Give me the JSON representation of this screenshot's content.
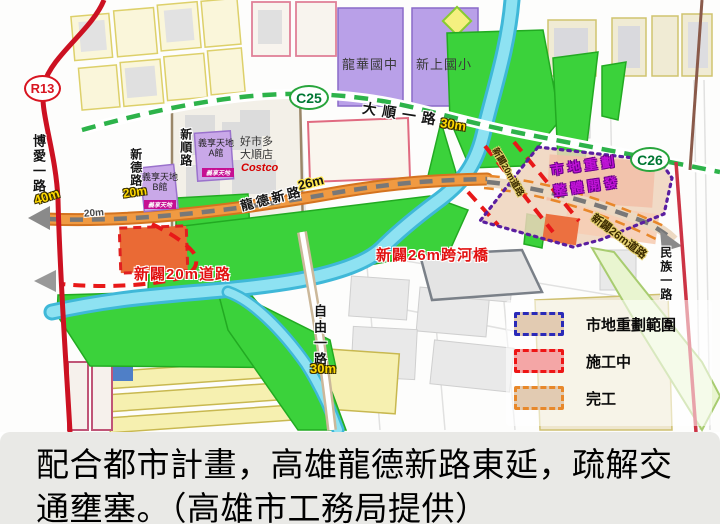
{
  "caption": {
    "line1": "配合都市計畫，高雄龍德新路東延，疏解交",
    "line2": "通壅塞。（高雄市工務局提供）"
  },
  "stations": {
    "r13": "R13",
    "c25": "C25",
    "c26": "C26"
  },
  "roads": {
    "boai": "博愛一路",
    "boai_width": "40m",
    "xinde": "新德路",
    "xinde_width": "20m",
    "xinshun": "新順路",
    "dashun": "大順一路",
    "dashun_width": "30m",
    "longde": "龍德新路",
    "longde_width": "26m",
    "longde_width2": "20m",
    "ziyou": "自由一路",
    "ziyou_width": "30m",
    "minzu": "民族一路",
    "new_road_20m": "新闢20m道路",
    "new_bridge_26m": "新闢26m跨河橋",
    "new_road_26m": "新闢26m道路",
    "new_road_20m_diag": "新闢20m道路"
  },
  "places": {
    "school_west": "龍華國中",
    "school_east": "新上國小",
    "costco_line1": "好市多",
    "costco_line2": "大順店",
    "costco_logo": "Costco",
    "yixiang_a_line1": "義享天地",
    "yixiang_a_line2": "A館",
    "yixiang_b_line1": "義享天地",
    "yixiang_b_line2": "B館",
    "yixiang_logo": "義享天地"
  },
  "zone_label": {
    "line1": "市地重劃",
    "line2": "整體開發"
  },
  "legend": {
    "items": [
      {
        "label": "市地重劃範圍",
        "border": "#2a2ab8",
        "fill": "#e2cbb2"
      },
      {
        "label": "施工中",
        "border": "#ee1515",
        "fill": "#f4a6a6"
      },
      {
        "label": "完工",
        "border": "#e8882a",
        "fill": "#e2cbb2"
      }
    ]
  },
  "colors": {
    "metro_red": "#cc1122",
    "lrt_green": "#2db34a",
    "construction_red": "#e81818",
    "completed_orange": "#ef9840",
    "zone_purple": "#5a1ea0",
    "river_cyan": "#8ee2f2",
    "school_purple": "#b9a0e8",
    "park_green": "#3bd23b"
  }
}
